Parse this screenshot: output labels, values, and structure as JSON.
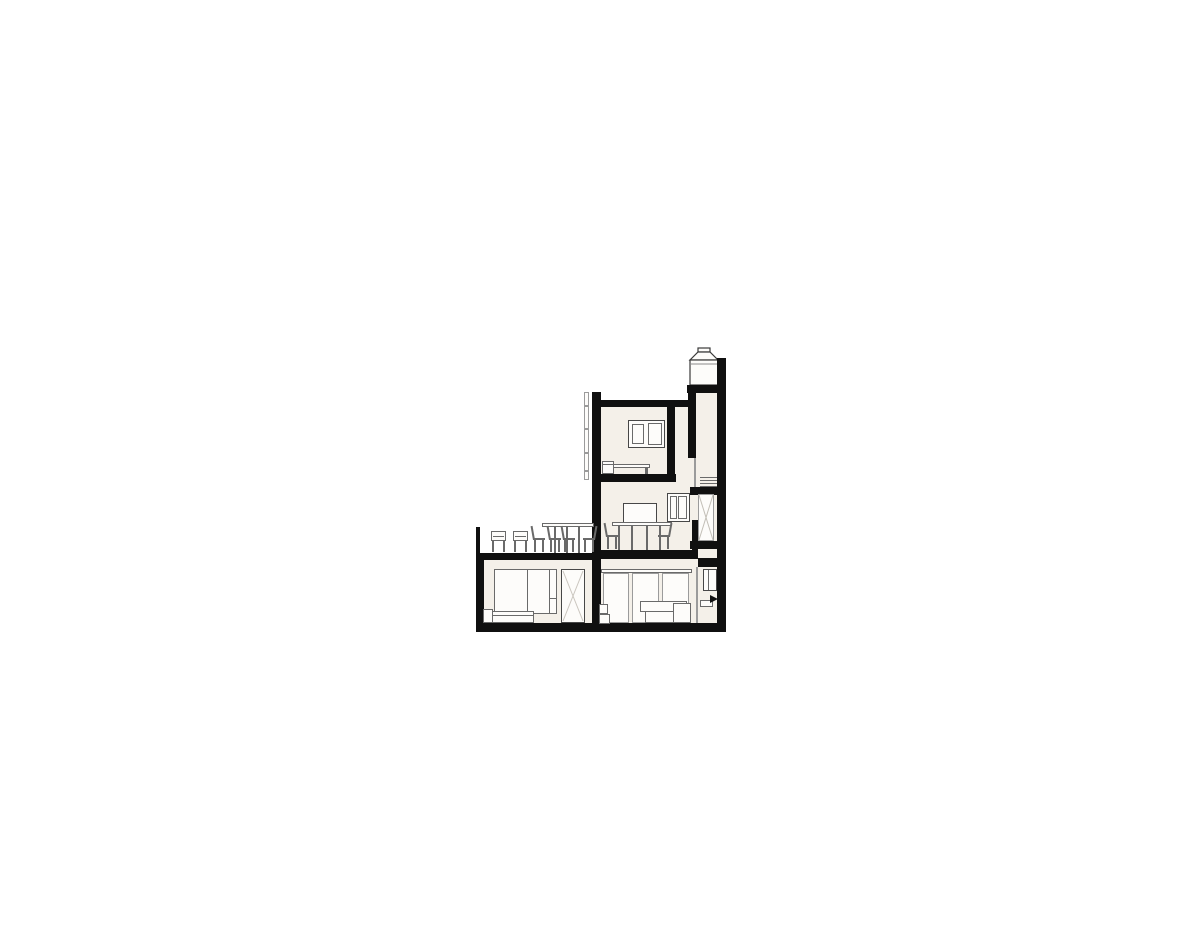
{
  "canvas": {
    "width": 1200,
    "height": 936,
    "background": "#ffffff"
  },
  "drawing": {
    "kind": "architectural cross-section of an L-shaped house",
    "colors": {
      "ink": "#101010",
      "interior": "#f4f0e9",
      "furniture_line": "#6a6a6a",
      "light_line": "#9b9b9b",
      "paper": "#fdfcfa"
    },
    "levels": [
      {
        "name": "roof-terrace",
        "items": [
          "parapet",
          "lounge-chair",
          "lounge-chair",
          "outdoor-table",
          "outdoor-chair",
          "outdoor-chair",
          "outdoor-chair",
          "outdoor-chair"
        ]
      },
      {
        "name": "upper-bedroom",
        "items": [
          "wall-picture",
          "bed",
          "nightstand",
          "exterior-ladder"
        ]
      },
      {
        "name": "dining-room",
        "items": [
          "tv-panel",
          "dining-table",
          "dining-chair",
          "dining-chair",
          "window"
        ]
      },
      {
        "name": "ground-bedroom",
        "items": [
          "wardrobe",
          "bed",
          "headboard",
          "glazed-door"
        ]
      },
      {
        "name": "living-room",
        "items": [
          "glazed-wall",
          "sofa",
          "side-cabinet"
        ]
      },
      {
        "name": "entry",
        "items": [
          "window",
          "bench",
          "entry-arrow"
        ]
      },
      {
        "name": "stair-shaft",
        "items": [
          "stair-treads",
          "glass-screen"
        ]
      },
      {
        "name": "roof",
        "items": [
          "chimney"
        ]
      }
    ]
  }
}
